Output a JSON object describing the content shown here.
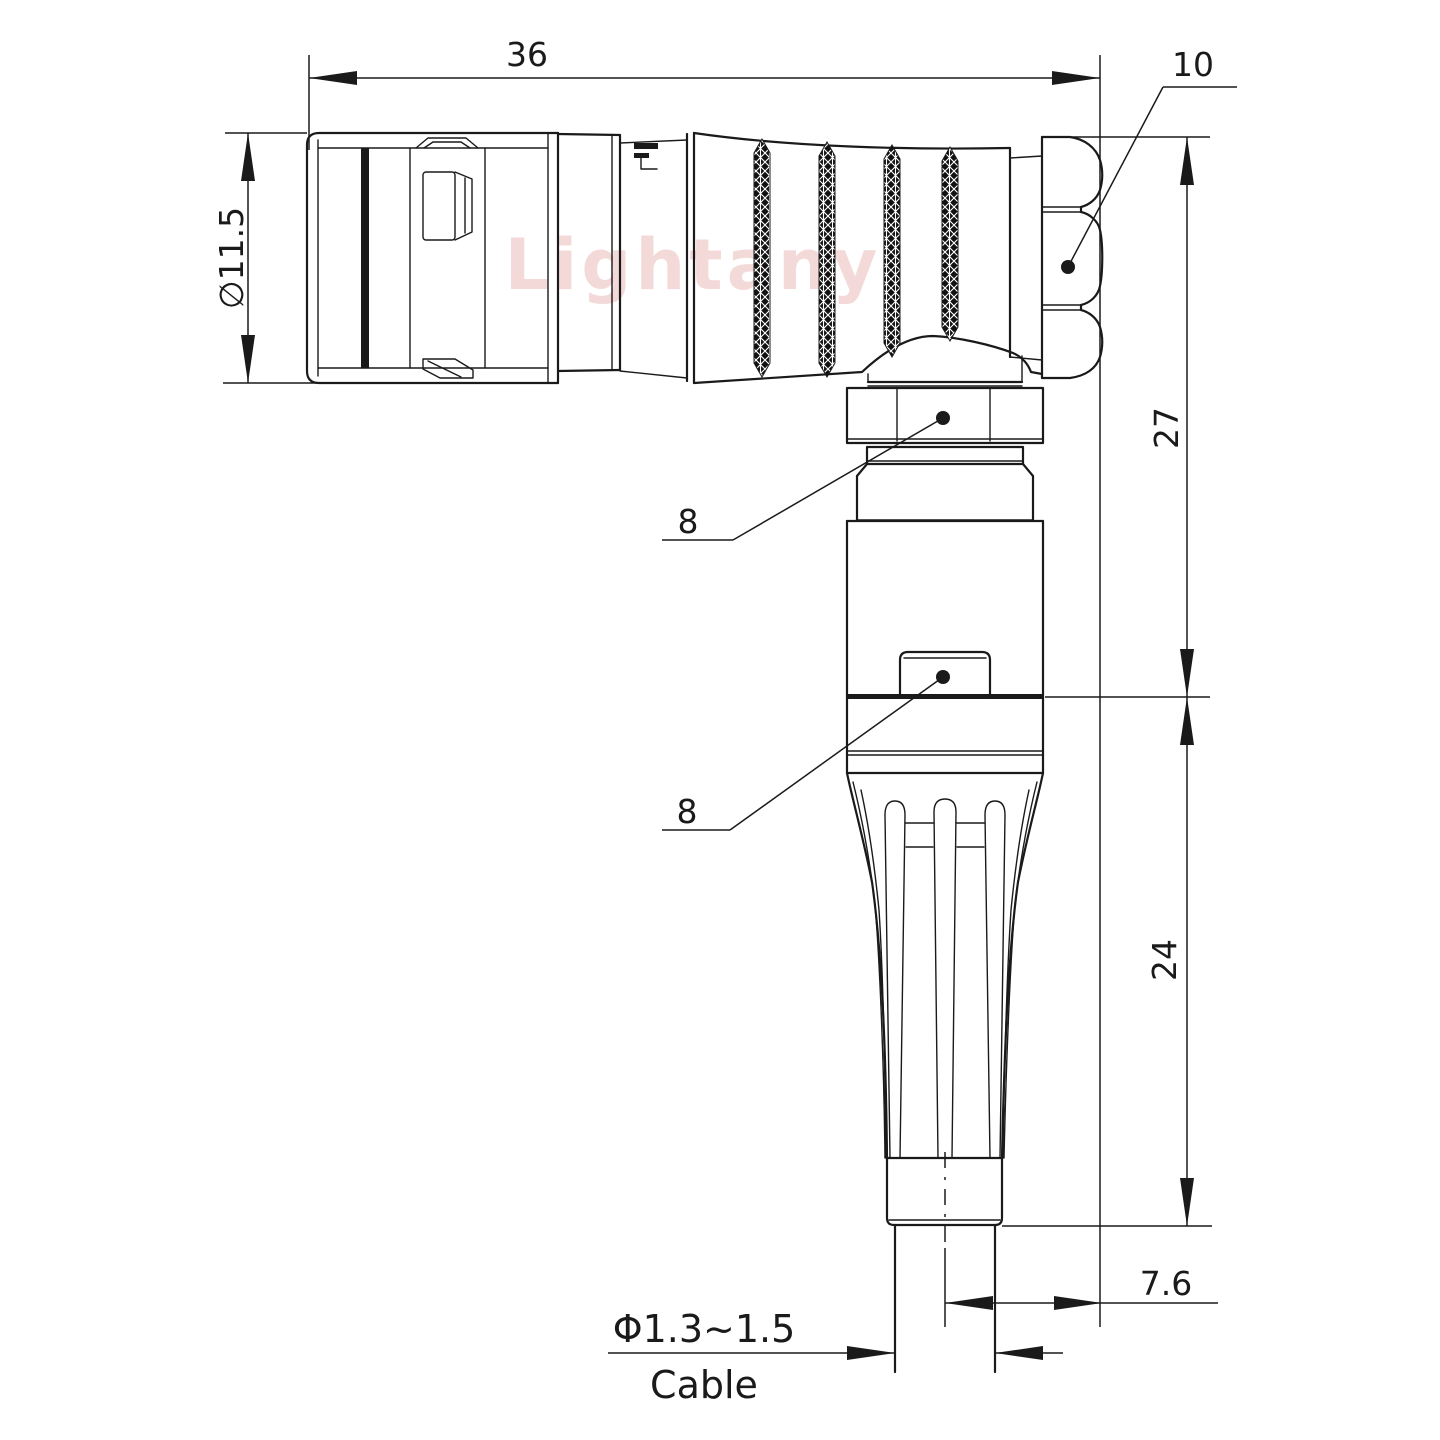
{
  "drawing": {
    "type": "connector-dimension-drawing",
    "view": "right-angle plug side view",
    "watermark": {
      "text": "Lightany",
      "color": "#e39c9c"
    },
    "colors": {
      "line": "#1a1a1a",
      "background": "#ffffff",
      "knurl": "#111111"
    },
    "labels": {
      "overall_length": "36",
      "nut_face": "10",
      "front_diameter": "∅11.5",
      "upper_height": "27",
      "lower_height": "24",
      "coupling_hex": "8",
      "body_hex": "8",
      "cable_offset": "7.6",
      "cable_diameter": "Φ1.3~1.5",
      "cable_label": "Cable"
    }
  }
}
